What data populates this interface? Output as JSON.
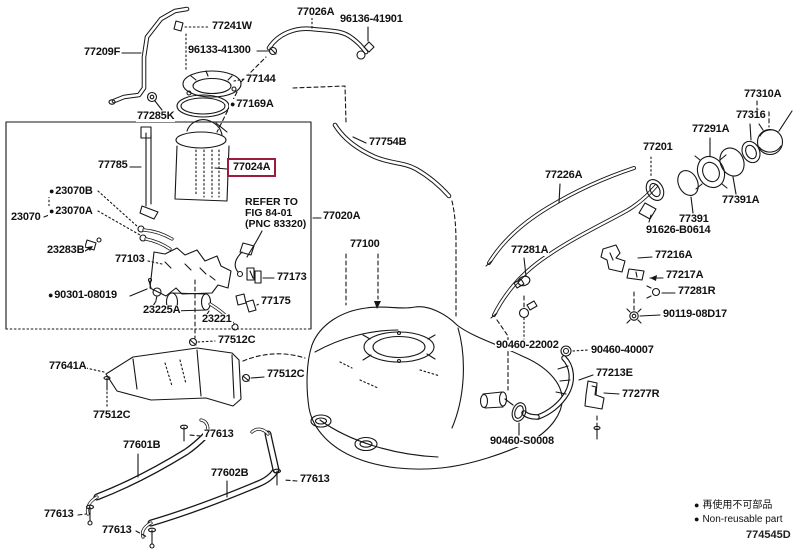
{
  "colors": {
    "line_color": "#161616",
    "highlight_box": "#9d1b3f",
    "background": "#ffffff"
  },
  "markers": {
    "non_reusable_dot": "●"
  },
  "figure_code": "774545D",
  "legend": {
    "jp_label": "再使用不可部品",
    "en_label": "Non-reusable part"
  },
  "refer_note": {
    "line1": "REFER TO",
    "line2": "FIG 84-01",
    "line3": "(PNC 83320)"
  },
  "labels": [
    {
      "text": "77209F"
    },
    {
      "text": "77241W"
    },
    {
      "text": "96133-41300"
    },
    {
      "text": "77026A"
    },
    {
      "text": "96136-41901"
    },
    {
      "text": "77144"
    },
    {
      "text": "77169A",
      "non_reusable": true
    },
    {
      "text": "77285K"
    },
    {
      "text": "77785"
    },
    {
      "text": "77024A",
      "highlighted": true
    },
    {
      "text": "23070B",
      "non_reusable": true
    },
    {
      "text": "23070A",
      "non_reusable": true
    },
    {
      "text": "23070"
    },
    {
      "text": "23283B"
    },
    {
      "text": "77103"
    },
    {
      "text": "77020A"
    },
    {
      "text": "77173"
    },
    {
      "text": "90301-08019",
      "non_reusable": true
    },
    {
      "text": "23225A"
    },
    {
      "text": "23221"
    },
    {
      "text": "77175"
    },
    {
      "text": "77512C"
    },
    {
      "text": "77754B"
    },
    {
      "text": "77100"
    },
    {
      "text": "77226A"
    },
    {
      "text": "77281A"
    },
    {
      "text": "77201"
    },
    {
      "text": "77291A"
    },
    {
      "text": "77310A"
    },
    {
      "text": "77316"
    },
    {
      "text": "77391A"
    },
    {
      "text": "77391"
    },
    {
      "text": "91626-B0614"
    },
    {
      "text": "77216A"
    },
    {
      "text": "77217A"
    },
    {
      "text": "77281R"
    },
    {
      "text": "90119-08D17"
    },
    {
      "text": "90460-22002"
    },
    {
      "text": "90460-40007"
    },
    {
      "text": "77213E"
    },
    {
      "text": "77277R"
    },
    {
      "text": "90460-S0008"
    },
    {
      "text": "77641A"
    },
    {
      "text": "77512C"
    },
    {
      "text": "77512C"
    },
    {
      "text": "77613"
    },
    {
      "text": "77601B"
    },
    {
      "text": "77602B"
    },
    {
      "text": "77613"
    },
    {
      "text": "77613"
    },
    {
      "text": "77613"
    }
  ]
}
